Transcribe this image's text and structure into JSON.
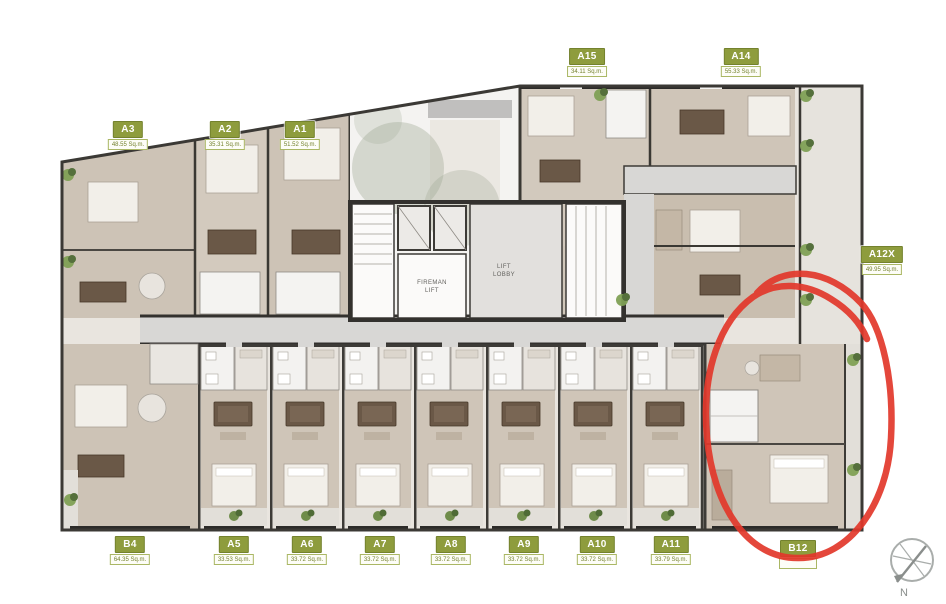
{
  "plan": {
    "units": [
      {
        "name": "A3",
        "area": "48.55 Sq.m."
      },
      {
        "name": "A2",
        "area": "35.31 Sq.m."
      },
      {
        "name": "A1",
        "area": "51.52 Sq.m."
      },
      {
        "name": "A15",
        "area": "34.11 Sq.m."
      },
      {
        "name": "A14",
        "area": "55.33 Sq.m."
      },
      {
        "name": "A12X",
        "area": "49.95 Sq.m."
      },
      {
        "name": "B4",
        "area": "64.35 Sq.m."
      },
      {
        "name": "A5",
        "area": "33.53 Sq.m."
      },
      {
        "name": "A6",
        "area": "33.72 Sq.m."
      },
      {
        "name": "A7",
        "area": "33.72 Sq.m."
      },
      {
        "name": "A8",
        "area": "33.72 Sq.m."
      },
      {
        "name": "A9",
        "area": "33.72 Sq.m."
      },
      {
        "name": "A10",
        "area": "33.72 Sq.m."
      },
      {
        "name": "A11",
        "area": "33.79 Sq.m."
      },
      {
        "name": "B12",
        "area": ""
      }
    ],
    "core": {
      "fireman_lift": "FIREMAN\nLIFT",
      "lift_lobby": "LIFT\nLOBBY"
    },
    "compass": {
      "label": "N"
    },
    "annotation": {
      "description": "hand-drawn red circle highlighting unit B12",
      "color": "#e2372a"
    },
    "colors": {
      "label_green": "#8e9c3d",
      "wall": "#33312e",
      "room_floor": "#cfc5b8",
      "corridor": "#d8d7d5"
    }
  }
}
